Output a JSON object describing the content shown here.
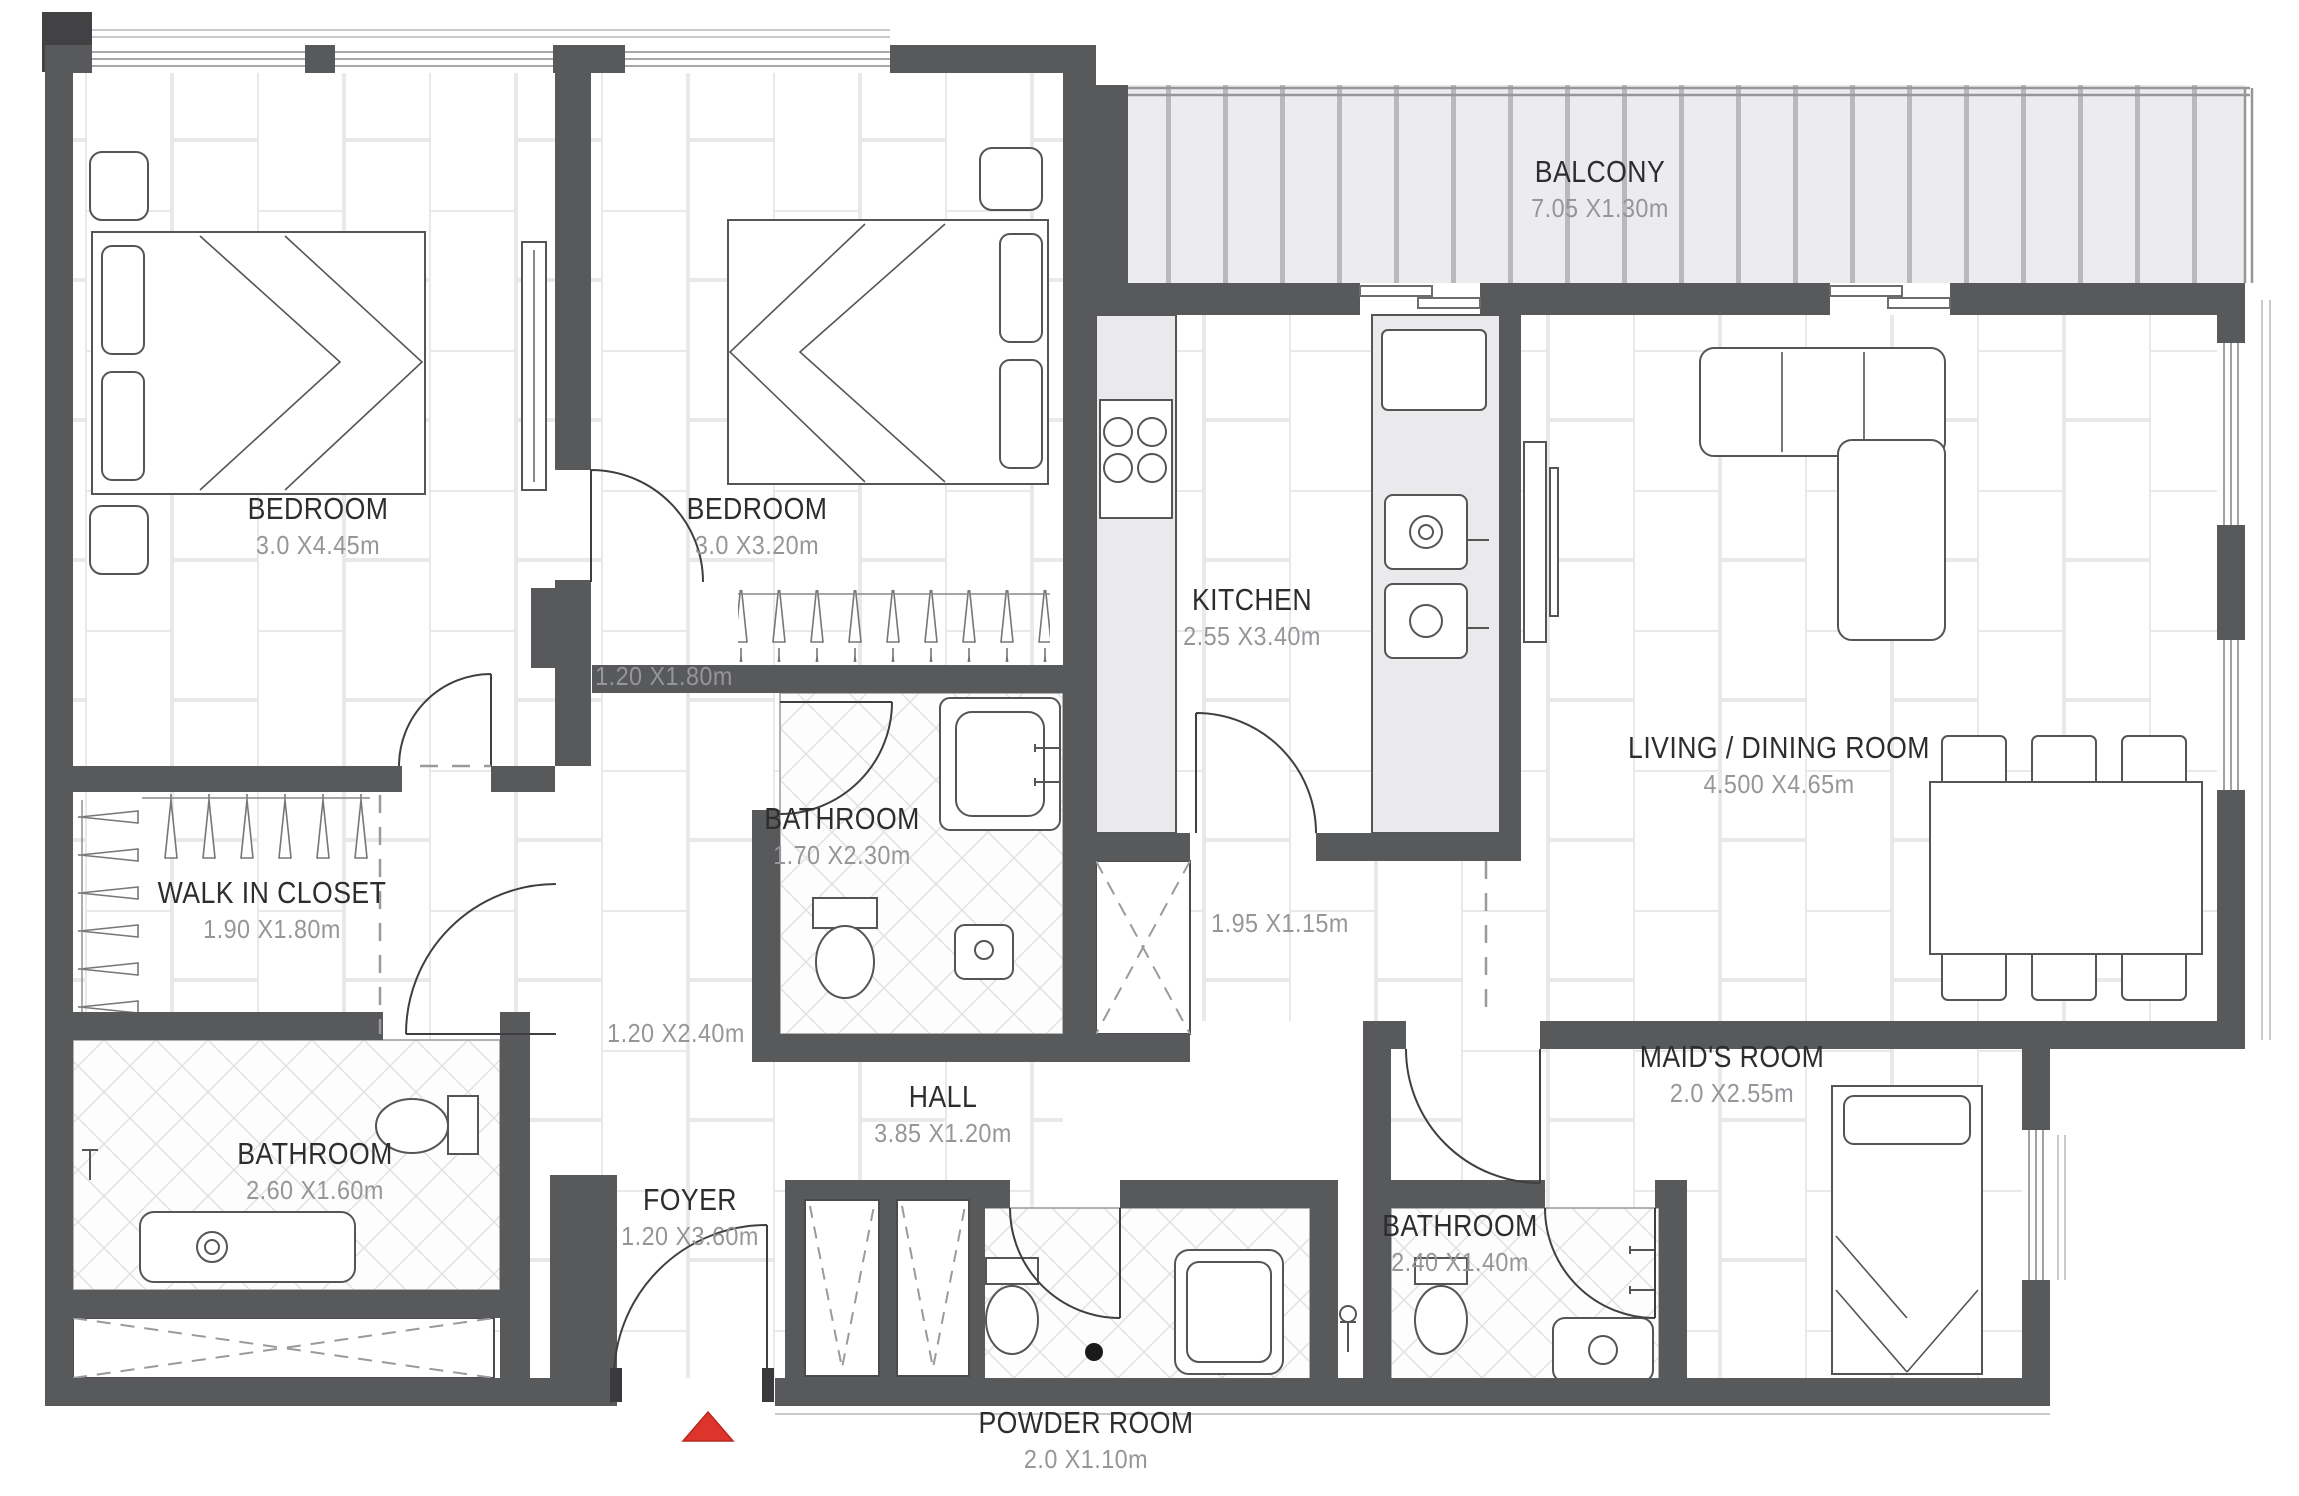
{
  "rooms": {
    "balcony": {
      "name": "BALCONY",
      "dims": "7.05  X1.30m"
    },
    "bedroom1": {
      "name": "BEDROOM",
      "dims": "3.0  X4.45m"
    },
    "bedroom2": {
      "name": "BEDROOM",
      "dims": "3.0  X3.20m"
    },
    "kitchen": {
      "name": "KITCHEN",
      "dims": "2.55  X3.40m"
    },
    "living": {
      "name": "LIVING / DINING ROOM",
      "dims": "4.500  X4.65m"
    },
    "walk_in_closet": {
      "name": "WALK IN CLOSET",
      "dims": "1.90  X1.80m"
    },
    "bathroom_main": {
      "name": "BATHROOM",
      "dims": "1.70  X2.30m"
    },
    "bathroom_master": {
      "name": "BATHROOM",
      "dims": "2.60  X1.60m"
    },
    "hall": {
      "name": "HALL",
      "dims": "3.85  X1.20m"
    },
    "foyer": {
      "name": "FOYER",
      "dims": "1.20  X3.60m"
    },
    "maids_room": {
      "name": "MAID'S ROOM",
      "dims": "2.0  X2.55m"
    },
    "bathroom_maid": {
      "name": "BATHROOM",
      "dims": "2.40  X1.40m"
    },
    "powder_room": {
      "name": "POWDER ROOM",
      "dims": "2.0  X1.10m"
    }
  },
  "passages": {
    "p1": "1.20  X1.80m",
    "p2": "1.20  X2.40m",
    "p3": "1.95  X1.15m"
  },
  "colors": {
    "wall": "#58595b",
    "wall_dark": "#424244",
    "entry_arrow": "#dd352b",
    "balcony_stripe": "#b9b9bc",
    "tile_line": "#e9e9e9",
    "hatch_line": "#e3e3e3"
  }
}
